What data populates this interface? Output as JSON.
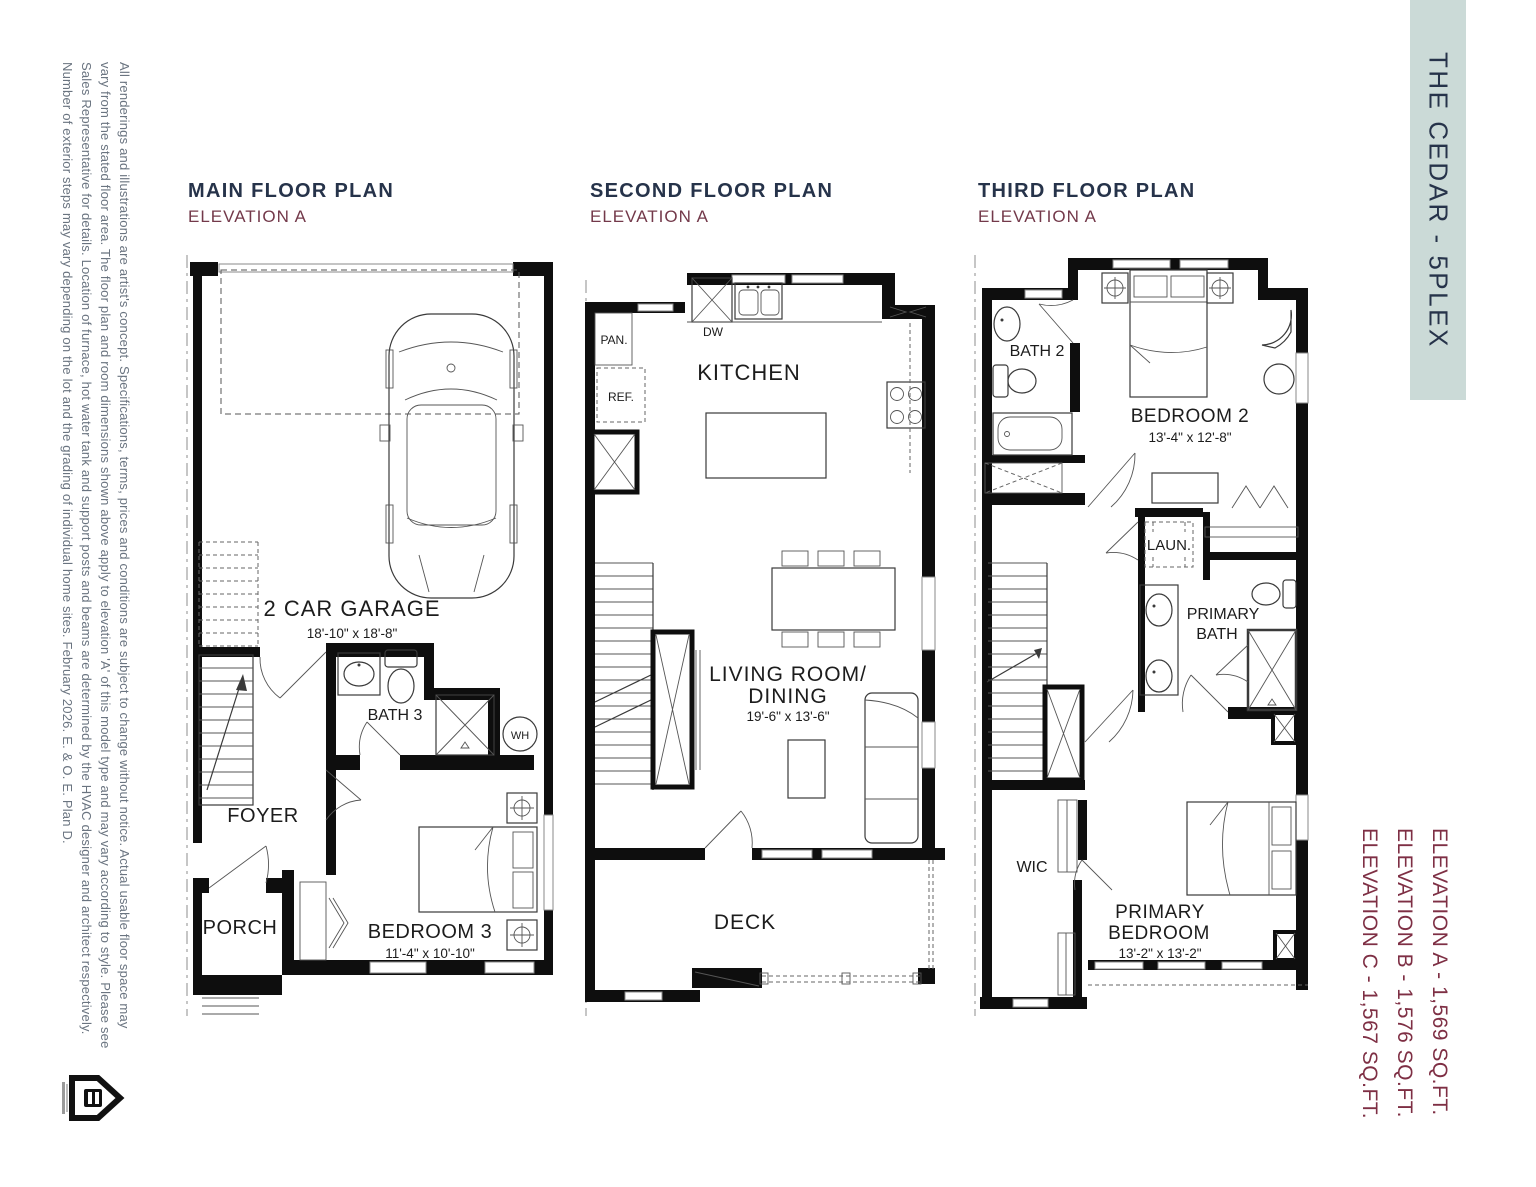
{
  "document": {
    "banner": {
      "text": "THE CEDAR - 5PLEX",
      "bg_color": "#cbdad7",
      "text_color": "#26334a"
    },
    "disclaimer": {
      "lines": [
        "All renderings and illustrations are artist's concept. Specifications, terms, prices and conditions are subject to change without notice. Actual usable floor space may",
        "vary from the stated floor area. The floor plan and room dimensions shown above apply to elevation 'A' of this model type and may vary according to style. Please see",
        "Sales Representative for details. Location of furnace, hot water tank and support posts and beams are determined by the HVAC designer and architect respectively.",
        "Number of exterior steps may vary depending on the lot and the grading of individual home sites. February 2026. E. & O. E. Plan D."
      ]
    },
    "elevation_summary": {
      "lines": [
        "ELEVATION A - 1,569 SQ.FT.",
        "ELEVATION B - 1,576 SQ.FT.",
        "ELEVATION C - 1,567 SQ.FT."
      ],
      "color": "#7e2f44"
    }
  },
  "plans": {
    "main": {
      "title": "MAIN FLOOR PLAN",
      "subtitle": "ELEVATION A",
      "garage": {
        "name": "2 CAR GARAGE",
        "dims": "18'-10\" x 18'-8\""
      },
      "bath3": {
        "name": "BATH 3"
      },
      "wh": {
        "name": "WH"
      },
      "foyer": {
        "name": "FOYER"
      },
      "porch": {
        "name": "PORCH"
      },
      "bedroom3": {
        "name": "BEDROOM 3",
        "dims": "11'-4\" x 10'-10\""
      }
    },
    "second": {
      "title": "SECOND FLOOR PLAN",
      "subtitle": "ELEVATION A",
      "pantry": {
        "name": "PAN."
      },
      "fridge": {
        "name": "REF."
      },
      "dishwasher": {
        "name": "DW"
      },
      "kitchen": {
        "name": "KITCHEN"
      },
      "living": {
        "line1": "LIVING ROOM/",
        "line2": "DINING",
        "dims": "19'-6\" x 13'-6\""
      },
      "deck": {
        "name": "DECK"
      }
    },
    "third": {
      "title": "THIRD FLOOR PLAN",
      "subtitle": "ELEVATION A",
      "bath2": {
        "name": "BATH 2"
      },
      "bedroom2": {
        "name": "BEDROOM 2",
        "dims": "13'-4\" x 12'-8\""
      },
      "laundry": {
        "name": "LAUN."
      },
      "primary_bath": {
        "line1": "PRIMARY",
        "line2": "BATH"
      },
      "wic": {
        "name": "WIC"
      },
      "primary_bedroom": {
        "line1": "PRIMARY",
        "line2": "BEDROOM",
        "dims": "13'-2\" x 13'-2\""
      }
    }
  },
  "colors": {
    "title": "#26334a",
    "subtitle": "#73394a",
    "linework": "#0e0e0e",
    "disclaimer_text": "#6a7480"
  }
}
